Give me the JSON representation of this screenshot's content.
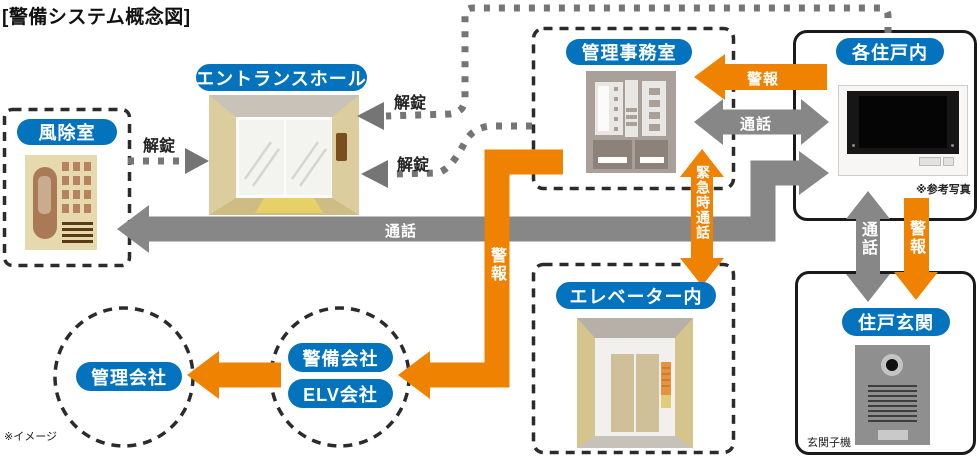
{
  "title": "[警備システム概念図]",
  "footnote": "※イメージ",
  "nodes": {
    "windbreak_room": "風除室",
    "entrance_hall": "エントランスホール",
    "management_office": "管理事務室",
    "each_unit": "各住戸内",
    "elevator": "エレベーター内",
    "unit_entrance": "住戸玄関",
    "management_company": "管理会社",
    "security_company": "警備会社",
    "elv_company": "ELV会社"
  },
  "labels": {
    "unlock": "解錠",
    "call": "通話",
    "alarm": "警報",
    "emergency_call": "緊急時通話"
  },
  "captions": {
    "reference_photo": "※参考写真",
    "entrance_unit": "玄関子機"
  },
  "colors": {
    "node_blue": "#0473bd",
    "signal_orange": "#ef8200",
    "signal_gray": "#878787",
    "dotted_gray": "#757575",
    "dash_black": "#2b2b2b"
  }
}
